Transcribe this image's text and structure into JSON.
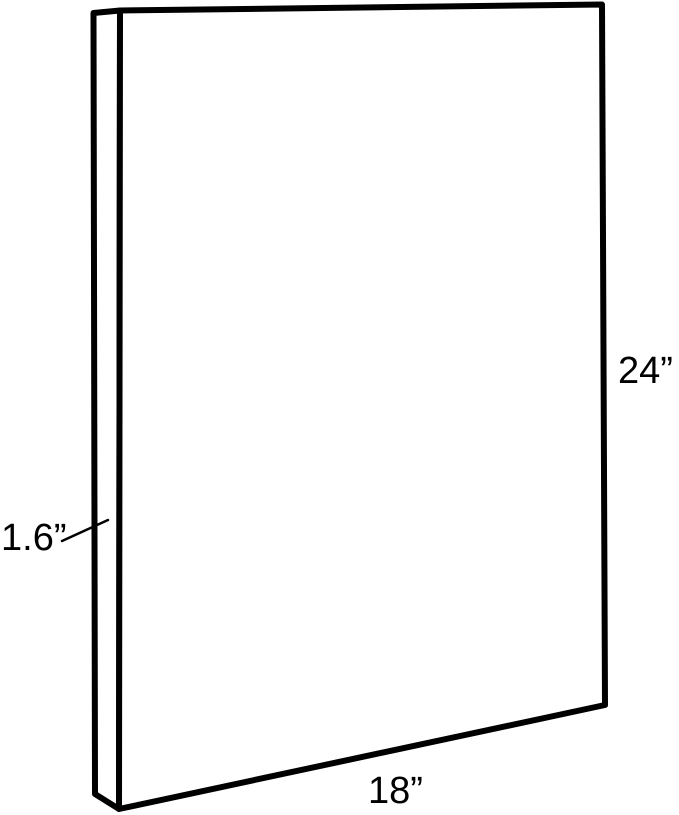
{
  "diagram": {
    "object": "rectangular-panel",
    "background_color": "#ffffff",
    "line_color": "#000000",
    "labels": {
      "height": "24”",
      "width": "18”",
      "depth": "1.6”"
    }
  }
}
